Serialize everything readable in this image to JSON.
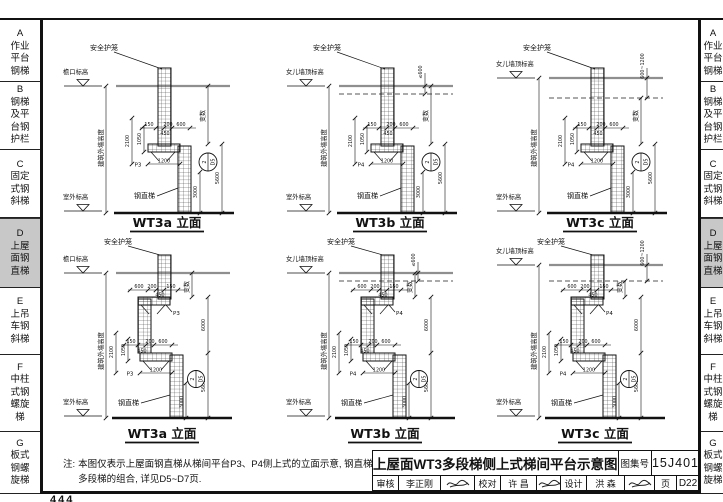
{
  "page_frame": {
    "bottom_page_number": "444"
  },
  "sidebar": {
    "sections": [
      {
        "letter": "A",
        "label": "作业平台钢梯",
        "active": false
      },
      {
        "letter": "B",
        "label": "钢梯及平台钢护栏",
        "active": false
      },
      {
        "letter": "C",
        "label": "固定式钢斜梯",
        "active": false
      },
      {
        "letter": "D",
        "label": "上屋面钢直梯",
        "active": true
      },
      {
        "letter": "E",
        "label": "上吊车钢斜梯",
        "active": false
      },
      {
        "letter": "F",
        "label": "中柱式钢螺旋梯",
        "active": false
      },
      {
        "letter": "G",
        "label": "板式钢螺旋梯",
        "active": false
      }
    ]
  },
  "note": {
    "prefix": "注:",
    "text": "本图仅表示上屋面钢直梯从梯间平台P3、P4侧上式的立面示意, 钢直梯多段梯的组合, 详见D5~D7页."
  },
  "title_block": {
    "title": "上屋面WT3多段梯侧上式梯间平台示意图",
    "atlas_label": "图集号",
    "atlas_no": "15J401",
    "page_label": "页",
    "page_no": "D22",
    "roles": [
      {
        "label": "审核",
        "name": "李正刚"
      },
      {
        "label": "校对",
        "name": "许 昌"
      },
      {
        "label": "设计",
        "name": "洪 森"
      }
    ]
  },
  "elevations": [
    {
      "name": "WT3a 立面",
      "segments": 2,
      "eave_label": "檐口标高",
      "ground_label": "室外标高",
      "cage_label": "安全护笼",
      "ladder_label": "钢直梯",
      "wall_height_label": "建筑外墙高度",
      "variable_label": "变数",
      "platform_mark": "P3",
      "parapet_dim": null,
      "dims": {
        "chain": [
          "150",
          "450",
          "200",
          "600"
        ],
        "platform_length": "1200",
        "v1": "2100",
        "v2": "1050",
        "lower": "5600",
        "bottom": "3000"
      },
      "detail_ref": {
        "num": "2",
        "sheet": "D5"
      }
    },
    {
      "name": "WT3b 立面",
      "segments": 2,
      "eave_label": "女儿墙顶标高",
      "ground_label": "室外标高",
      "cage_label": "安全护笼",
      "ladder_label": "钢直梯",
      "wall_height_label": "建筑外墙高度",
      "variable_label": "变数",
      "platform_mark": "P4",
      "parapet_dim": "≤600",
      "dims": {
        "chain": [
          "150",
          "450",
          "200",
          "600"
        ],
        "platform_length": "1200",
        "v1": "2100",
        "v2": "1050",
        "lower": "5600",
        "bottom": "3000"
      },
      "detail_ref": {
        "num": "2",
        "sheet": "D5"
      }
    },
    {
      "name": "WT3c 立面",
      "segments": 2,
      "eave_label": "女儿墙顶标高",
      "ground_label": "室外标高",
      "cage_label": "安全护笼",
      "ladder_label": "钢直梯",
      "wall_height_label": "建筑外墙高度",
      "variable_label": "变数",
      "platform_mark": "P4",
      "parapet_dim": "600~1200",
      "dims": {
        "chain": [
          "150",
          "450",
          "200",
          "600"
        ],
        "platform_length": "1200",
        "v1": "2100",
        "v2": "1050",
        "lower": "5600",
        "bottom": "3000"
      },
      "detail_ref": {
        "num": "2",
        "sheet": "D5"
      }
    },
    {
      "name": "WT3a 立面",
      "segments": 3,
      "eave_label": "檐口标高",
      "ground_label": "室外标高",
      "cage_label": "安全护笼",
      "ladder_label": "钢直梯",
      "wall_height_label": "建筑外墙高度",
      "variable_label": "变数",
      "platform_mark": "P3",
      "parapet_dim": null,
      "dims": {
        "chain": [
          "150",
          "450",
          "200",
          "600"
        ],
        "chain_upper": [
          "600",
          "200",
          "450",
          "150"
        ],
        "platform_length": "1200",
        "v1": "2100",
        "v2": "1050",
        "mid": "6000",
        "lower": "5600",
        "bottom": "3000"
      },
      "detail_ref": {
        "num": "2",
        "sheet": "D5"
      }
    },
    {
      "name": "WT3b 立面",
      "segments": 3,
      "eave_label": "女儿墙顶标高",
      "ground_label": "室外标高",
      "cage_label": "安全护笼",
      "ladder_label": "钢直梯",
      "wall_height_label": "建筑外墙高度",
      "variable_label": "变数",
      "platform_mark": "P4",
      "parapet_dim": "≤600",
      "dims": {
        "chain": [
          "150",
          "450",
          "200",
          "600"
        ],
        "chain_upper": [
          "600",
          "200",
          "450",
          "150"
        ],
        "platform_length": "1200",
        "v1": "2100",
        "v2": "1050",
        "mid": "6000",
        "lower": "5600",
        "bottom": "3000"
      },
      "detail_ref": {
        "num": "2",
        "sheet": "D5"
      }
    },
    {
      "name": "WT3c 立面",
      "segments": 3,
      "eave_label": "女儿墙顶标高",
      "ground_label": "室外标高",
      "cage_label": "安全护笼",
      "ladder_label": "钢直梯",
      "wall_height_label": "建筑外墙高度",
      "variable_label": "变数",
      "platform_mark": "P4",
      "parapet_dim": "600~1200",
      "dims": {
        "chain": [
          "150",
          "450",
          "200",
          "600"
        ],
        "chain_upper": [
          "600",
          "200",
          "450",
          "150"
        ],
        "platform_length": "1200",
        "v1": "2100",
        "v2": "1050",
        "mid": "6000",
        "lower": "5600",
        "bottom": "3000"
      },
      "detail_ref": {
        "num": "2",
        "sheet": "D5"
      }
    }
  ]
}
